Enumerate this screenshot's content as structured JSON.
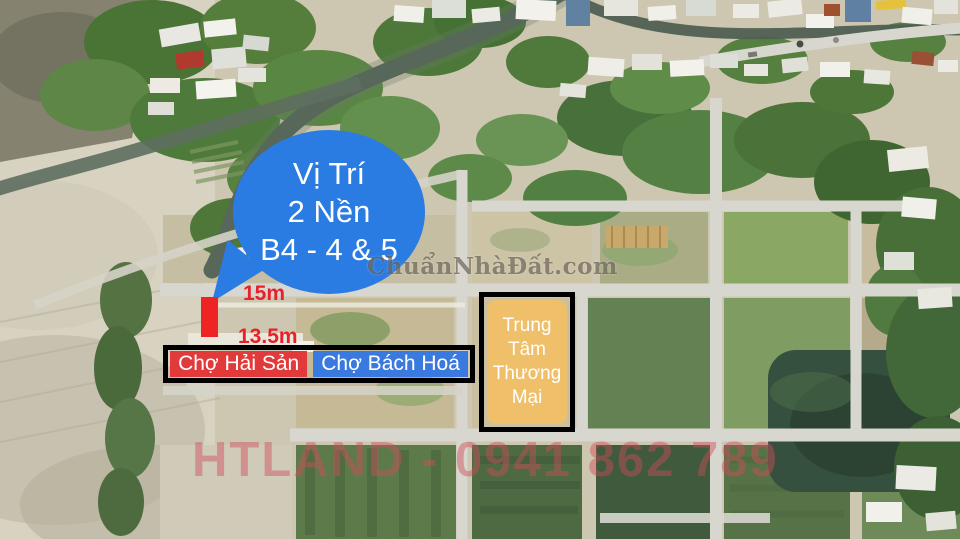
{
  "annotations": {
    "location_bubble": {
      "lines": [
        "Vị Trí",
        "2 Nền",
        "B4 - 4 & 5"
      ],
      "bg_color": "#2b7ce2",
      "text_color": "#ffffff"
    },
    "plot_marker": {
      "width_label": "15m",
      "depth_label": "13.5m",
      "label_color": "#e62129",
      "marker_color": "#ee2424"
    },
    "market_sign": {
      "seafood_label": "Chợ Hải Sản",
      "seafood_bg": "#e23a3a",
      "grocery_label": "Chợ Bách Hoá",
      "grocery_bg": "#3a79e0",
      "border_color": "#000000",
      "text_color": "#ffffff"
    },
    "mall_sign": {
      "lines": [
        "Trung",
        "Tâm",
        "Thương",
        "Mại"
      ],
      "bg_color": "#efbf6a",
      "border_color": "#000000",
      "text_color": "#ffffff"
    },
    "watermarks": {
      "site": "ChuẩnNhàĐất.com",
      "agent": "HTLAND - 0941 862 789"
    }
  }
}
